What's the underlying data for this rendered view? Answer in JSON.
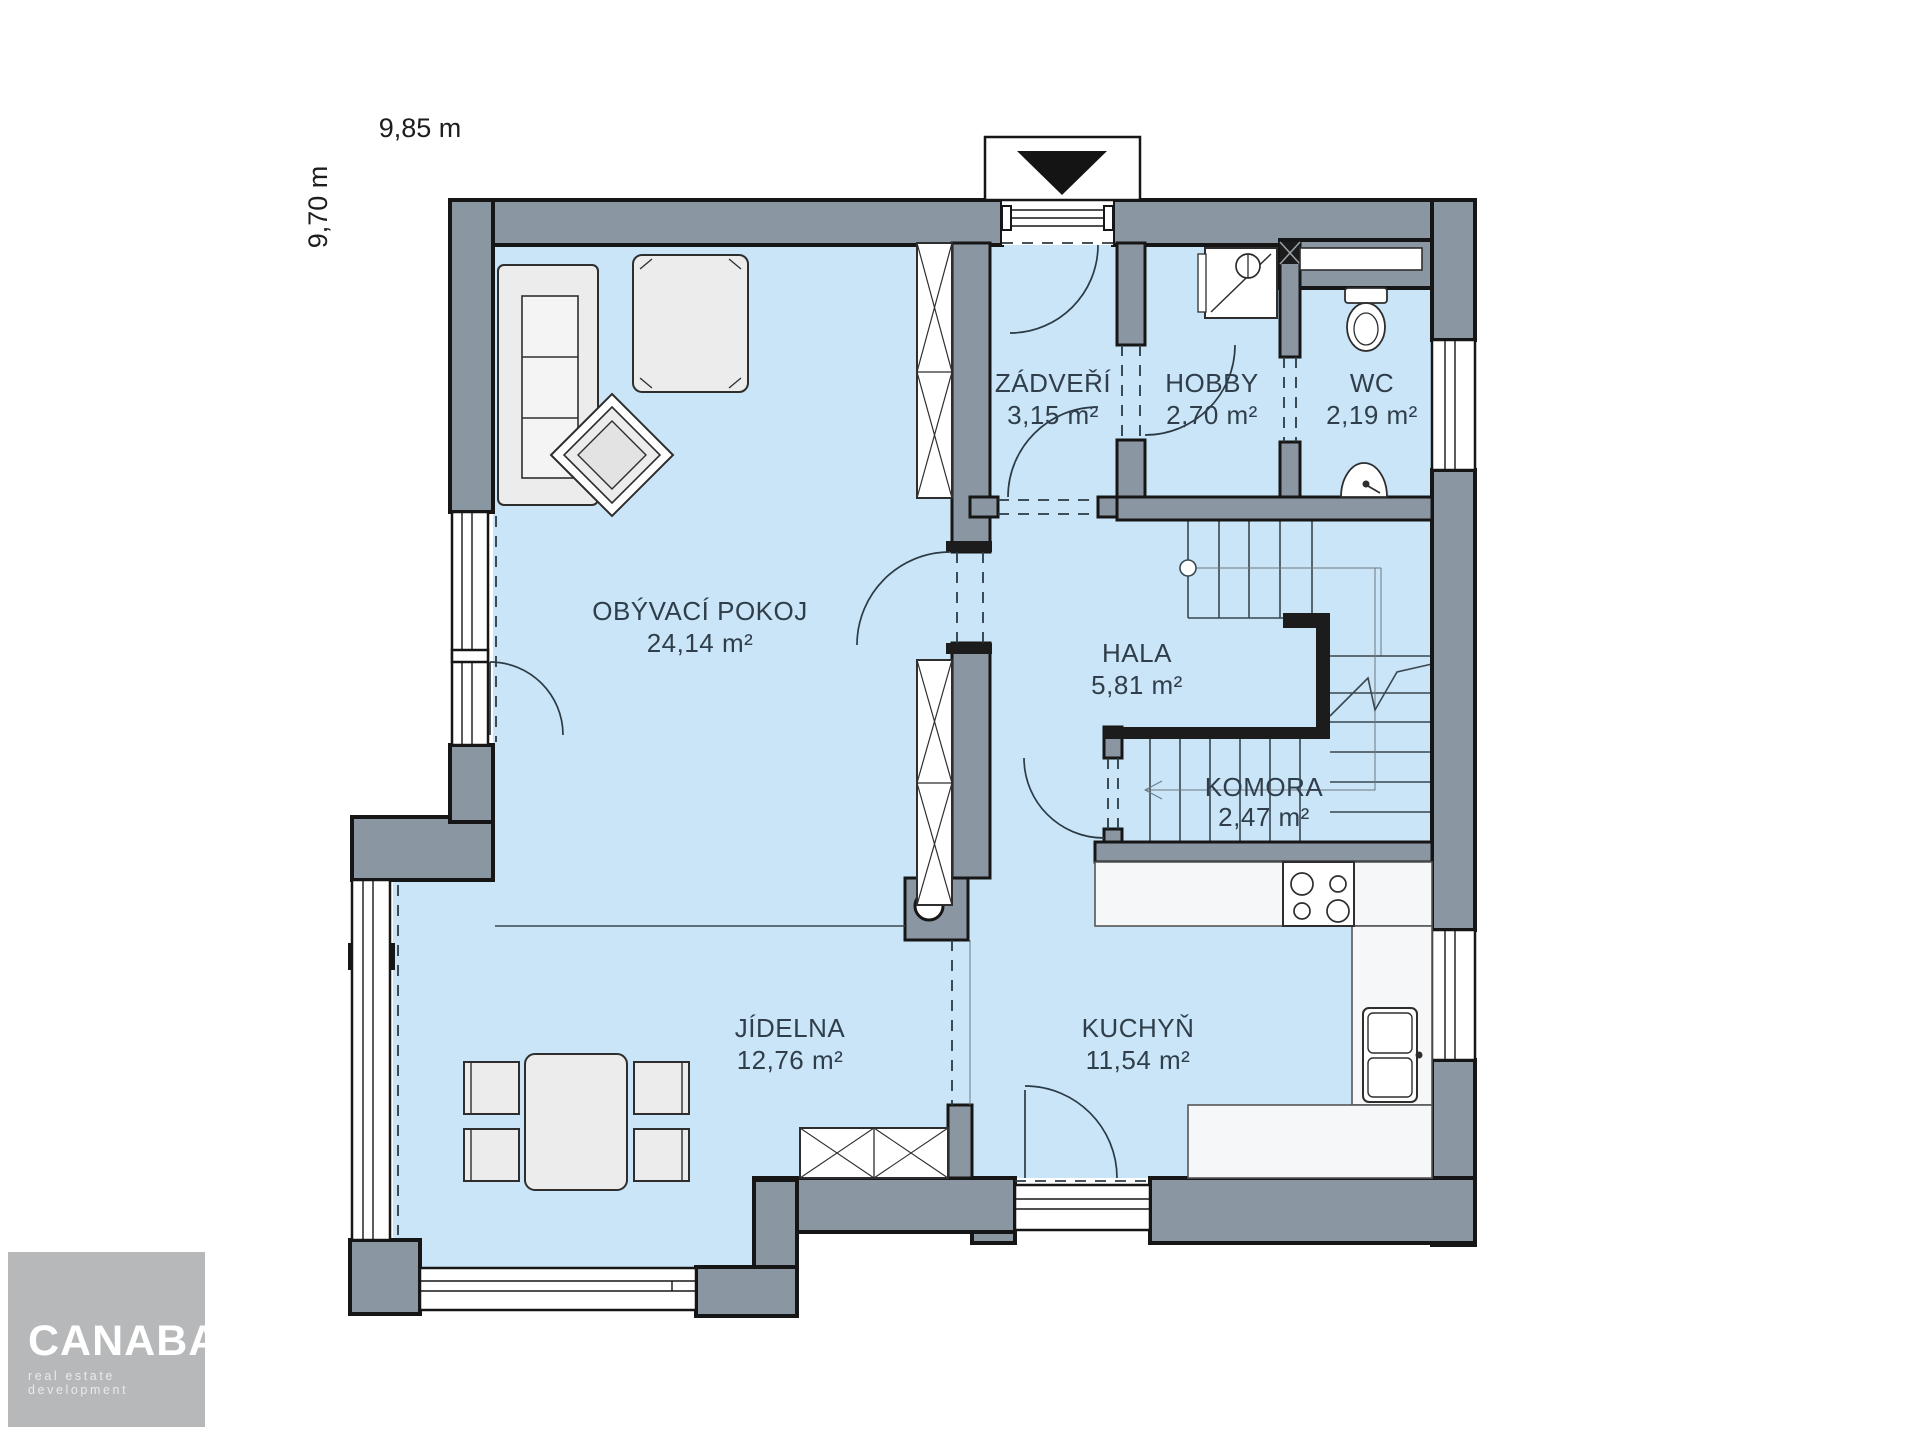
{
  "dimensions": {
    "width_label": "9,85 m",
    "height_label": "9,70 m"
  },
  "rooms": [
    {
      "id": "obyvaci-pokoj",
      "name": "OBÝVACÍ POKOJ",
      "area": "24,14 m²"
    },
    {
      "id": "zadveri",
      "name": "ZÁDVEŘÍ",
      "area": "3,15 m²"
    },
    {
      "id": "hobby",
      "name": "HOBBY",
      "area": "2,70 m²"
    },
    {
      "id": "wc",
      "name": "WC",
      "area": "2,19 m²"
    },
    {
      "id": "hala",
      "name": "HALA",
      "area": "5,81 m²"
    },
    {
      "id": "komora",
      "name": "KOMORA",
      "area": "2,47 m²"
    },
    {
      "id": "jidelna",
      "name": "JÍDELNA",
      "area": "12,76 m²"
    },
    {
      "id": "kuchyn",
      "name": "KUCHYŇ",
      "area": "11,54 m²"
    }
  ],
  "logo": {
    "brand": "CANABA",
    "registered": "®",
    "tagline": "real estate development"
  },
  "colors": {
    "floor": "#c9e5f7",
    "wall": "#8a97a2",
    "outline": "#161616",
    "label": "#2f3e4a",
    "furniture": "#ececec",
    "logo_bg": "#b6b8ba"
  }
}
